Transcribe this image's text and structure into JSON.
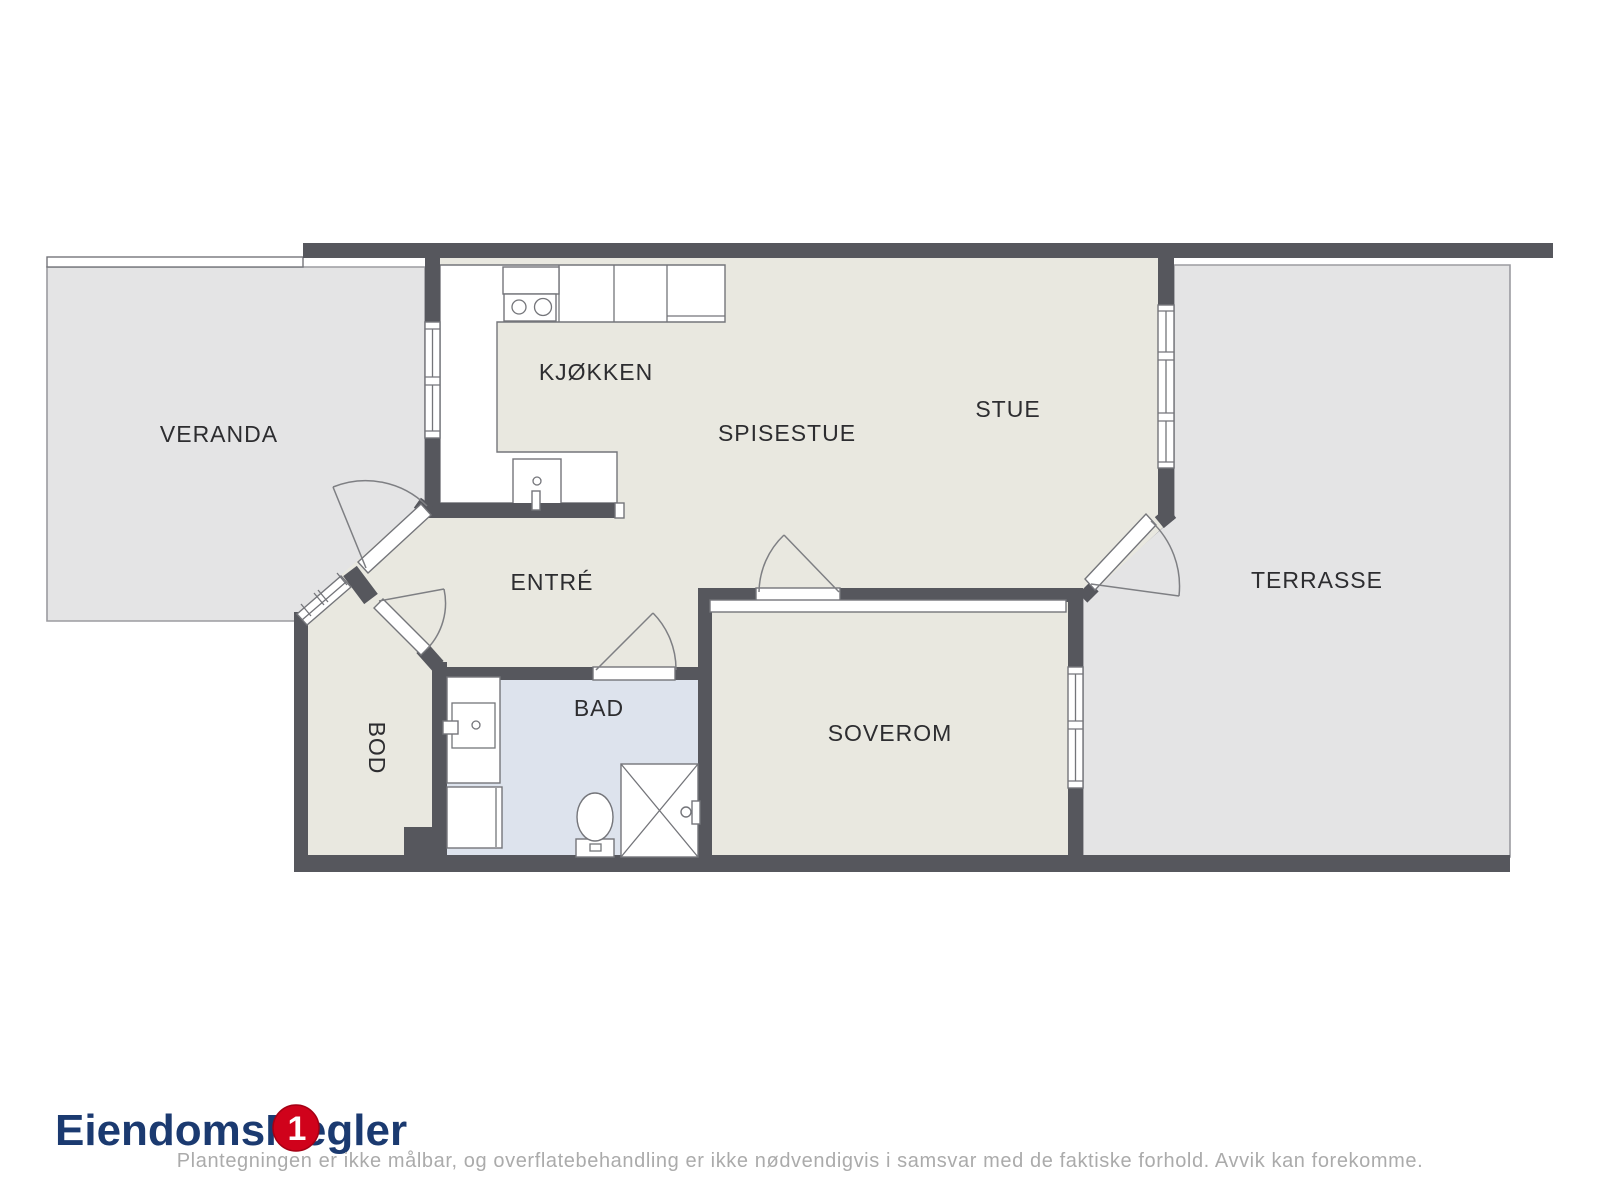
{
  "document": {
    "kind": "floor-plan"
  },
  "rooms": {
    "veranda": {
      "label": "VERANDA"
    },
    "kjokken": {
      "label": "KJØKKEN"
    },
    "spisestue": {
      "label": "SPISESTUE"
    },
    "stue": {
      "label": "STUE"
    },
    "terrasse": {
      "label": "TERRASSE"
    },
    "entre": {
      "label": "ENTRÉ"
    },
    "bad": {
      "label": "BAD"
    },
    "bod": {
      "label": "BOD"
    },
    "soverom": {
      "label": "SOVEROM"
    }
  },
  "branding": {
    "logo_text": "EiendomsMegler",
    "badge_number": "1",
    "logo_color": "#1b3a70",
    "badge_color": "#d0021b"
  },
  "disclaimer": "Plantegningen er ikke målbar, og overflatebehandling er ikke nødvendigvis i samsvar med de faktiske forhold. Avvik kan forekomme.",
  "colors": {
    "wall": "#56575d",
    "interior_floor": "#e9e8e0",
    "bathroom_floor": "#dde3ed",
    "outdoor_floor": "#e4e4e5",
    "outdoor_border": "#9b9ba0",
    "label_text": "#2d2d30",
    "disclaimer_text": "#ababab"
  },
  "fixtures": [
    "stove-icon",
    "kitchen-sink-icon",
    "bathroom-sink-icon",
    "washing-machine-icon",
    "toilet-icon",
    "shower-icon",
    "wardrobe-strip"
  ]
}
